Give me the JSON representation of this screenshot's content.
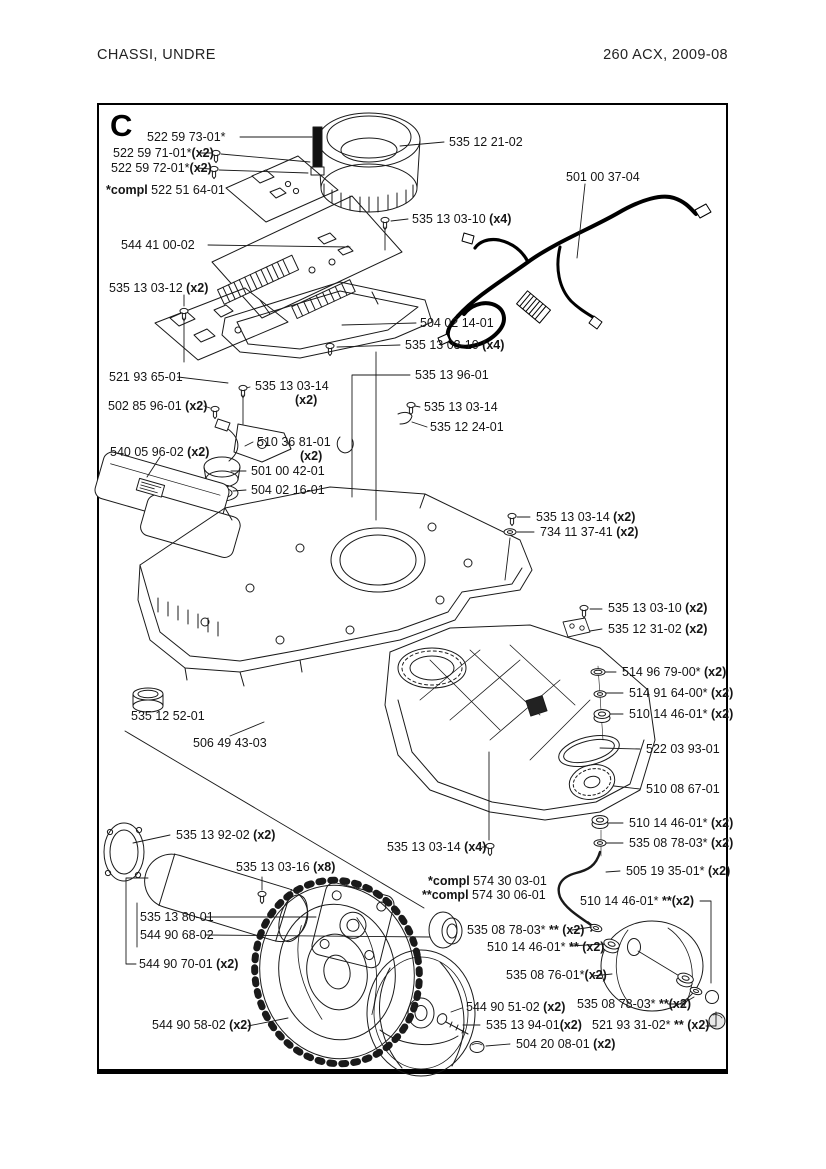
{
  "page": {
    "header_left": "CHASSI,  UNDRE",
    "header_right": "260 ACX, 2009-08",
    "section_letter": "C"
  },
  "diagram": {
    "labels": [
      {
        "x": 147,
        "y": 131,
        "text": "522 59 73-01*"
      },
      {
        "x": 113,
        "y": 147,
        "text": "522 59 71-01*",
        "count": "(x2)"
      },
      {
        "x": 111,
        "y": 162,
        "text": "522 59 72-01*",
        "count": "(x2)"
      },
      {
        "x": 106,
        "y": 184,
        "pre": "*compl",
        "text": " 522 51 64-01"
      },
      {
        "x": 121,
        "y": 239,
        "text": "544 41 00-02"
      },
      {
        "x": 449,
        "y": 136,
        "text": "535 12 21-02"
      },
      {
        "x": 566,
        "y": 171,
        "text": "501 00 37-04"
      },
      {
        "x": 412,
        "y": 213,
        "text": "535 13 03-10",
        "count": " (x4)"
      },
      {
        "x": 109,
        "y": 282,
        "text": "535 13 03-12",
        "count": " (x2)"
      },
      {
        "x": 420,
        "y": 317,
        "text": "504 02 14-01"
      },
      {
        "x": 405,
        "y": 339,
        "text": "535 13 03-10",
        "count": " (x4)"
      },
      {
        "x": 109,
        "y": 371,
        "text": "521 93 65-01"
      },
      {
        "x": 255,
        "y": 380,
        "text": "535 13 03-14"
      },
      {
        "x": 295,
        "y": 394,
        "count": "(x2)"
      },
      {
        "x": 415,
        "y": 369,
        "text": "535 13 96-01"
      },
      {
        "x": 108,
        "y": 400,
        "text": "502 85 96-01",
        "count": " (x2)"
      },
      {
        "x": 424,
        "y": 401,
        "text": "535 13 03-14"
      },
      {
        "x": 430,
        "y": 421,
        "text": "535 12 24-01"
      },
      {
        "x": 257,
        "y": 436,
        "text": "510 36 81-01"
      },
      {
        "x": 300,
        "y": 450,
        "count": "(x2)"
      },
      {
        "x": 110,
        "y": 446,
        "text": "540 05 96-02",
        "count": " (x2)"
      },
      {
        "x": 251,
        "y": 465,
        "text": "501 00 42-01"
      },
      {
        "x": 251,
        "y": 484,
        "text": "504 02 16-01"
      },
      {
        "x": 536,
        "y": 511,
        "text": "535 13 03-14",
        "count": " (x2)"
      },
      {
        "x": 540,
        "y": 526,
        "text": "734 11 37-41",
        "count": " (x2)"
      },
      {
        "x": 608,
        "y": 602,
        "text": "535 13 03-10",
        "count": " (x2)"
      },
      {
        "x": 608,
        "y": 623,
        "text": "535 12 31-02",
        "count": " (x2)"
      },
      {
        "x": 622,
        "y": 666,
        "text": "514 96 79-00*",
        "count": " (x2)"
      },
      {
        "x": 629,
        "y": 687,
        "text": "514 91 64-00*",
        "count": " (x2)"
      },
      {
        "x": 629,
        "y": 708,
        "text": "510 14 46-01*",
        "count": " (x2)"
      },
      {
        "x": 646,
        "y": 743,
        "text": "522 03 93-01"
      },
      {
        "x": 131,
        "y": 710,
        "text": "535 12 52-01"
      },
      {
        "x": 193,
        "y": 737,
        "text": "506 49 43-03"
      },
      {
        "x": 646,
        "y": 783,
        "text": "510 08 67-01"
      },
      {
        "x": 629,
        "y": 817,
        "text": "510 14 46-01*",
        "count": " (x2)"
      },
      {
        "x": 629,
        "y": 837,
        "text": "535 08 78-03*",
        "count": " (x2)"
      },
      {
        "x": 176,
        "y": 829,
        "text": "535 13 92-02",
        "count": " (x2)"
      },
      {
        "x": 387,
        "y": 841,
        "text": "535 13 03-14",
        "count": " (x4)"
      },
      {
        "x": 626,
        "y": 865,
        "text": "505 19 35-01*",
        "count": " (x2)"
      },
      {
        "x": 428,
        "y": 875,
        "pre": "*compl",
        "text": " 574 30 03-01"
      },
      {
        "x": 422,
        "y": 889,
        "pre": "**compl",
        "text": " 574 30 06-01"
      },
      {
        "x": 236,
        "y": 861,
        "text": "535 13 03-16",
        "count": " (x8)"
      },
      {
        "x": 580,
        "y": 895,
        "text": "510 14 46-01*",
        "count": " **(x2)"
      },
      {
        "x": 467,
        "y": 924,
        "text": "535 08 78-03*",
        "count": " ** (x2)"
      },
      {
        "x": 487,
        "y": 941,
        "text": "510 14 46-01*",
        "count": " ** (x2)"
      },
      {
        "x": 140,
        "y": 911,
        "text": "535 13 80-01"
      },
      {
        "x": 140,
        "y": 929,
        "text": "544 90 68-02"
      },
      {
        "x": 506,
        "y": 969,
        "text": "535 08 76-01*",
        "count": "(x2)"
      },
      {
        "x": 139,
        "y": 958,
        "text": "544 90 70-01",
        "count": " (x2)"
      },
      {
        "x": 577,
        "y": 998,
        "text": "535 08 78-03*",
        "count": " **(x2)"
      },
      {
        "x": 592,
        "y": 1019,
        "text": "521 93 31-02*",
        "count": " ** (x2)"
      },
      {
        "x": 152,
        "y": 1019,
        "text": "544 90 58-02",
        "count": " (x2)"
      },
      {
        "x": 466,
        "y": 1001,
        "text": "544 90 51-02",
        "count": " (x2)"
      },
      {
        "x": 486,
        "y": 1019,
        "text": "535 13 94-01",
        "count": "(x2)"
      },
      {
        "x": 516,
        "y": 1038,
        "text": "504 20 08-01",
        "count": " (x2)"
      }
    ]
  }
}
